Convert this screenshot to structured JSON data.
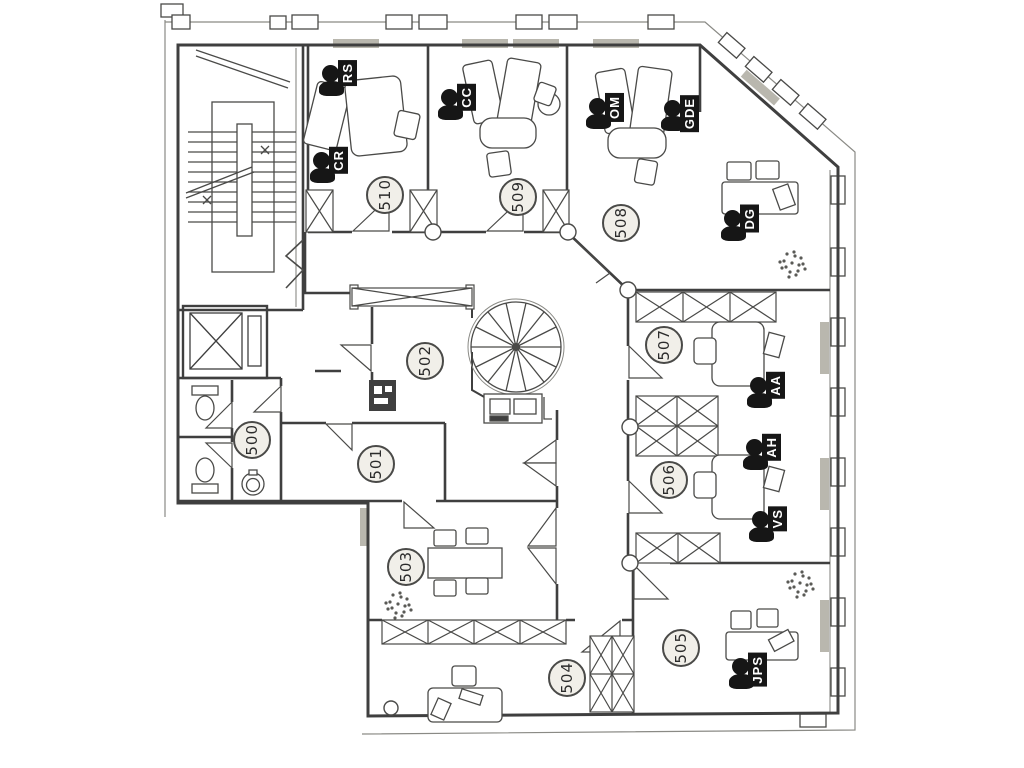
{
  "floor_plan": {
    "rooms": [
      {
        "number": "500"
      },
      {
        "number": "501"
      },
      {
        "number": "502"
      },
      {
        "number": "503"
      },
      {
        "number": "504"
      },
      {
        "number": "505"
      },
      {
        "number": "506"
      },
      {
        "number": "507"
      },
      {
        "number": "508"
      },
      {
        "number": "509"
      },
      {
        "number": "510"
      }
    ],
    "occupants": [
      {
        "initials": "RS",
        "room": "510"
      },
      {
        "initials": "CR",
        "room": "510"
      },
      {
        "initials": "CC",
        "room": "509"
      },
      {
        "initials": "OM",
        "room": "508"
      },
      {
        "initials": "GDE",
        "room": "508"
      },
      {
        "initials": "DG",
        "room": "508"
      },
      {
        "initials": "AA",
        "room": "507"
      },
      {
        "initials": "AH",
        "room": "506"
      },
      {
        "initials": "VS",
        "room": "506"
      },
      {
        "initials": "JPS",
        "room": "505"
      }
    ],
    "colors": {
      "wall_line": "#3f3f3f",
      "thin_line": "#8a8a85",
      "label_fill": "#f1efe9",
      "marker_black": "#161616",
      "radiator_fill": "#b9b7ae",
      "background": "#ffffff"
    }
  }
}
